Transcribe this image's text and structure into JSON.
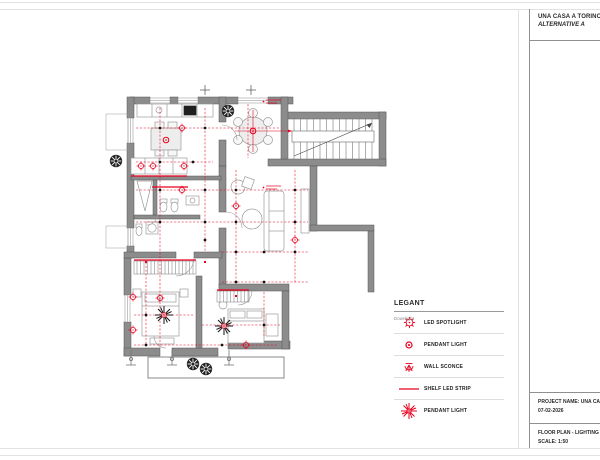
{
  "header": {
    "project_title": "UNA CASA A TORINO",
    "alternative": "ALTERNATIVE A"
  },
  "title_block": {
    "project_name_line": "PROJECT NAME: UNA CASA A T",
    "date": "07-02-2026",
    "drawing_title_line": "FLOOR PLAN - LIGHTING PLAN L",
    "scale": "SCALE: 1:50"
  },
  "legend": {
    "title": "LEGANT",
    "annotation": "Downlight",
    "items": [
      {
        "icon": "led-spotlight-icon",
        "label": "LED SPOTLIGHT"
      },
      {
        "icon": "pendant-light-icon",
        "label": "PENDANT LIGHT"
      },
      {
        "icon": "wall-sconce-icon",
        "label": "WALL SCONCE"
      },
      {
        "icon": "shelf-led-strip-icon",
        "label": "SHELF LED STRIP"
      },
      {
        "icon": "chandelier-pendant-icon",
        "label": "PENDANT LIGHT"
      }
    ]
  },
  "colors": {
    "accent_red": "#e8001e",
    "wall_gray": "#8c8c8c",
    "border_gray": "#e2e2e2",
    "text_dark": "#2a2a2a"
  }
}
